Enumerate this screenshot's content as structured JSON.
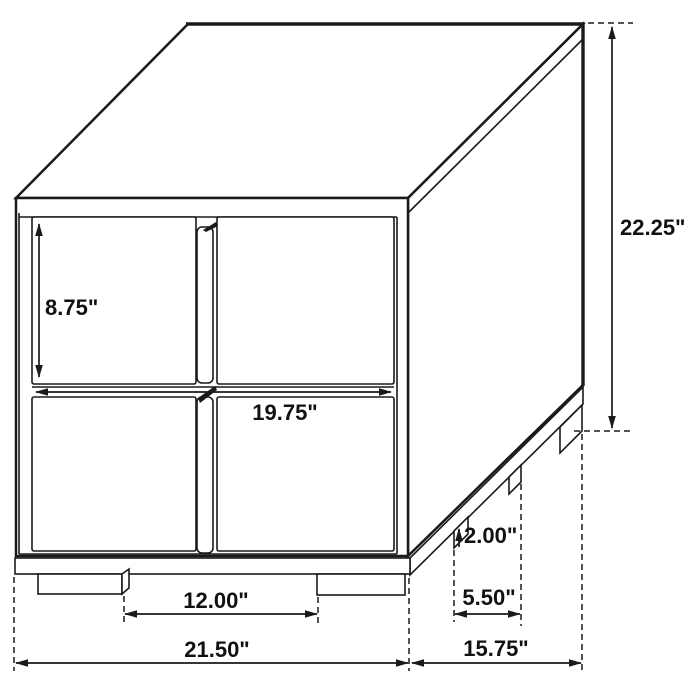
{
  "diagram": {
    "type": "furniture-dimension-drawing",
    "subject": "two-drawer nightstand, isometric line drawing with dimension callouts",
    "unit": "inches",
    "colors": {
      "line": "#1a1a1a",
      "background": "#ffffff",
      "text": "#111111"
    },
    "labels": {
      "drawer_height": "8.75\"",
      "overall_height": "22.25\"",
      "drawer_width": "19.75\"",
      "leg_height": "2.00\"",
      "front_leg_gap": "12.00\"",
      "side_leg_gap": "5.50\"",
      "overall_width": "21.50\"",
      "overall_depth": "15.75\""
    }
  }
}
